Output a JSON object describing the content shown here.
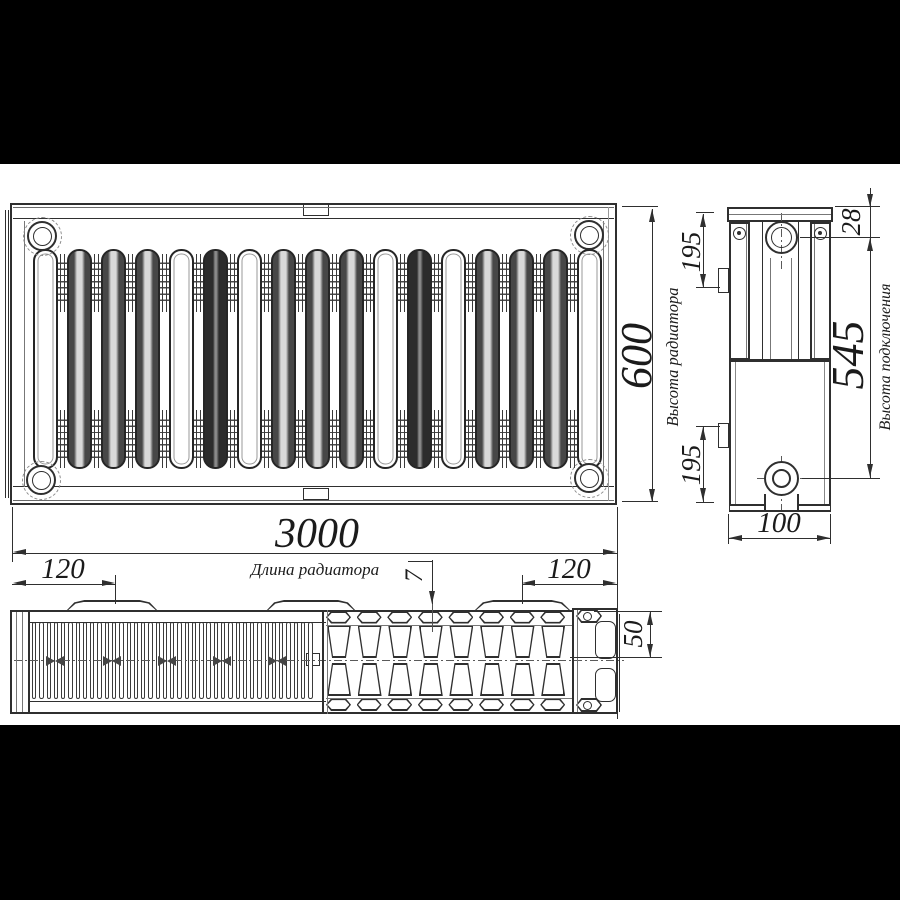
{
  "dims": {
    "length": "3000",
    "height": "600",
    "connection_height": "545",
    "depth": "100",
    "top_port_offset": "28",
    "tab_offset_top": "195",
    "tab_offset_bottom": "195",
    "bracket_offset_left": "120",
    "bracket_offset_right": "120",
    "panel_depth": "50",
    "fin_gap": "7"
  },
  "labels": {
    "radiator_height": "Высота радиатора",
    "connection_height": "Высота подключения",
    "radiator_length": "Длина радиатора"
  },
  "colors": {
    "ink": "#2f2f2f",
    "paper": "#ffffff",
    "letterbox": "#000000"
  }
}
